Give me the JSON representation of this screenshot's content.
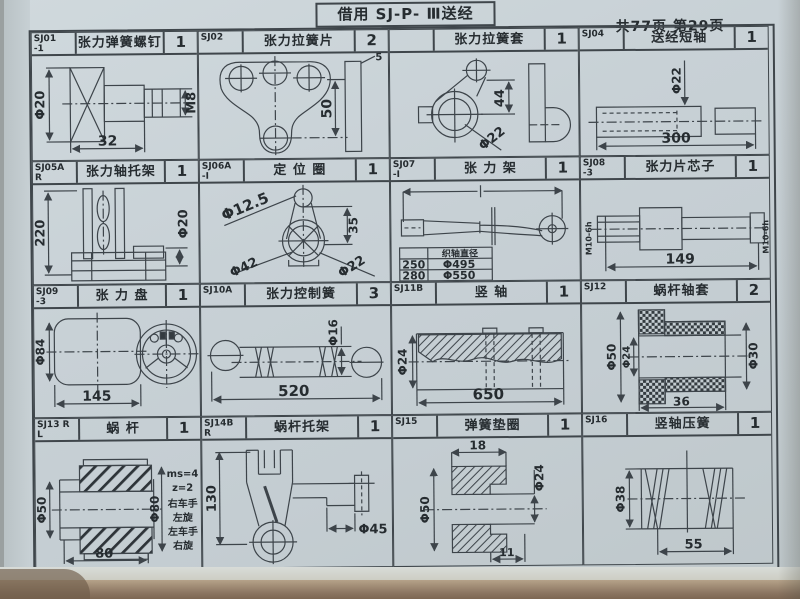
{
  "page": {
    "title": "借用 SJ-P- Ⅲ送经",
    "page_info": "共77页 第29页"
  },
  "cells": [
    {
      "id1": "SJ01",
      "id2": "-1",
      "name": "张力弹簧螺钉",
      "qty": "1",
      "dims": [
        "Φ20",
        "32",
        "M8"
      ]
    },
    {
      "id1": "SJ02",
      "id2": "",
      "name": "张力拉簧片",
      "qty": "2",
      "dims": [
        "50",
        "5"
      ]
    },
    {
      "id1": "",
      "id2": "",
      "name": "张力拉簧套",
      "qty": "1",
      "dims": [
        "44",
        "Φ22"
      ]
    },
    {
      "id1": "SJ04",
      "id2": "",
      "name": "送经短轴",
      "qty": "1",
      "dims": [
        "Φ22",
        "300"
      ]
    },
    {
      "id1": "SJ05A R",
      "id2": "L -Ⅰ",
      "name": "张力轴托架",
      "qty": "1",
      "dims": [
        "220",
        "Φ20"
      ]
    },
    {
      "id1": "SJ06A",
      "id2": "-Ⅰ",
      "name": "定 位 圈",
      "qty": "1",
      "dims": [
        "Φ12.5",
        "35",
        "Φ42",
        "Φ22"
      ]
    },
    {
      "id1": "SJ07",
      "id2": "-Ⅰ",
      "name": "张 力 架",
      "qty": "1",
      "table": {
        "col2_header": "织轴直径",
        "rows": [
          [
            "250",
            "Φ495"
          ],
          [
            "280",
            "Φ550"
          ]
        ]
      }
    },
    {
      "id1": "SJ08",
      "id2": "-3",
      "name": "张力片芯子",
      "qty": "1",
      "dims": [
        "M10-6h",
        "149",
        "M10-6h"
      ]
    },
    {
      "id1": "SJ09",
      "id2": "-3",
      "name": "张 力 盘",
      "qty": "1",
      "dims": [
        "Φ84",
        "145"
      ]
    },
    {
      "id1": "SJ10A",
      "id2": "",
      "name": "张力控制簧",
      "qty": "3",
      "dims": [
        "Φ16",
        "520"
      ]
    },
    {
      "id1": "SJ11B",
      "id2": "",
      "name": "竖 轴",
      "qty": "1",
      "dims": [
        "Φ24",
        "650"
      ]
    },
    {
      "id1": "SJ12",
      "id2": "",
      "name": "蜗杆轴套",
      "qty": "2",
      "dims": [
        "Φ50",
        "Φ24",
        "Φ30",
        "36"
      ]
    },
    {
      "id1": "SJ13 R",
      "id2": "L",
      "name": "蜗 杆",
      "qty": "1",
      "dims": [
        "Φ50",
        "Φ80",
        "80"
      ],
      "notes": [
        "ms=4",
        "z=2",
        "右车手",
        "左旋",
        "左车手",
        "右旋"
      ]
    },
    {
      "id1": "SJ14B R",
      "id2": "L -Ⅲ",
      "name": "蜗杆托架",
      "qty": "1",
      "dims": [
        "130",
        "Φ45"
      ]
    },
    {
      "id1": "SJ15",
      "id2": "",
      "name": "弹簧垫圈",
      "qty": "1",
      "dims": [
        "18",
        "Φ24",
        "Φ50",
        "11"
      ]
    },
    {
      "id1": "SJ16",
      "id2": "",
      "name": "竖轴压簧",
      "qty": "1",
      "dims": [
        "Φ38",
        "55"
      ]
    }
  ]
}
